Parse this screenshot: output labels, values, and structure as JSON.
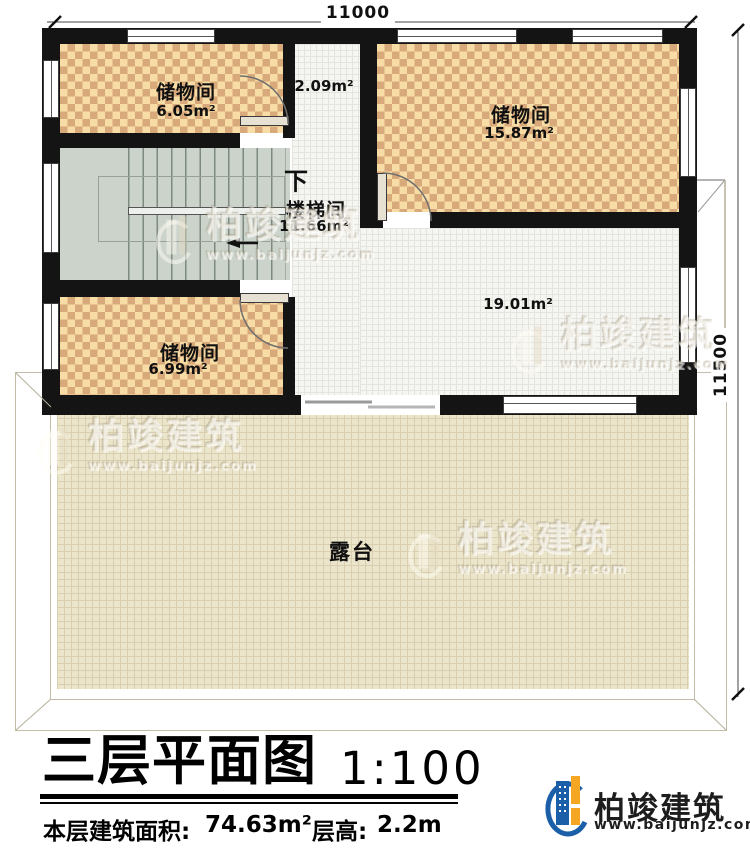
{
  "dimensions": {
    "top": "11000",
    "right": "11500"
  },
  "rooms": {
    "storage_tl": {
      "name": "储物间",
      "area": "6.05m²"
    },
    "corridor": {
      "area": "2.09m²"
    },
    "storage_tr": {
      "name": "储物间",
      "area": "15.87m²"
    },
    "stairwell": {
      "name": "楼梯间",
      "area": "11.66m²",
      "down_label": "下"
    },
    "storage_bl": {
      "name": "储物间",
      "area": "6.99m²"
    },
    "hall": {
      "area": "19.01m²"
    },
    "terrace": {
      "name": "露台"
    }
  },
  "titleblock": {
    "title": "三层平面图",
    "scale": "1:100",
    "floor_area_label": "本层建筑面积:",
    "floor_area_value": "74.63m²",
    "floor_height_label": "层高:",
    "floor_height_value": "2.2m"
  },
  "brand": {
    "name": "柏竣建筑",
    "url": "www.baijunjz.com",
    "colors": {
      "blue": "#1b5fa8",
      "orange": "#f5a623"
    }
  },
  "watermark": {
    "name": "柏竣建筑",
    "url": "www.baijunjz.com"
  }
}
